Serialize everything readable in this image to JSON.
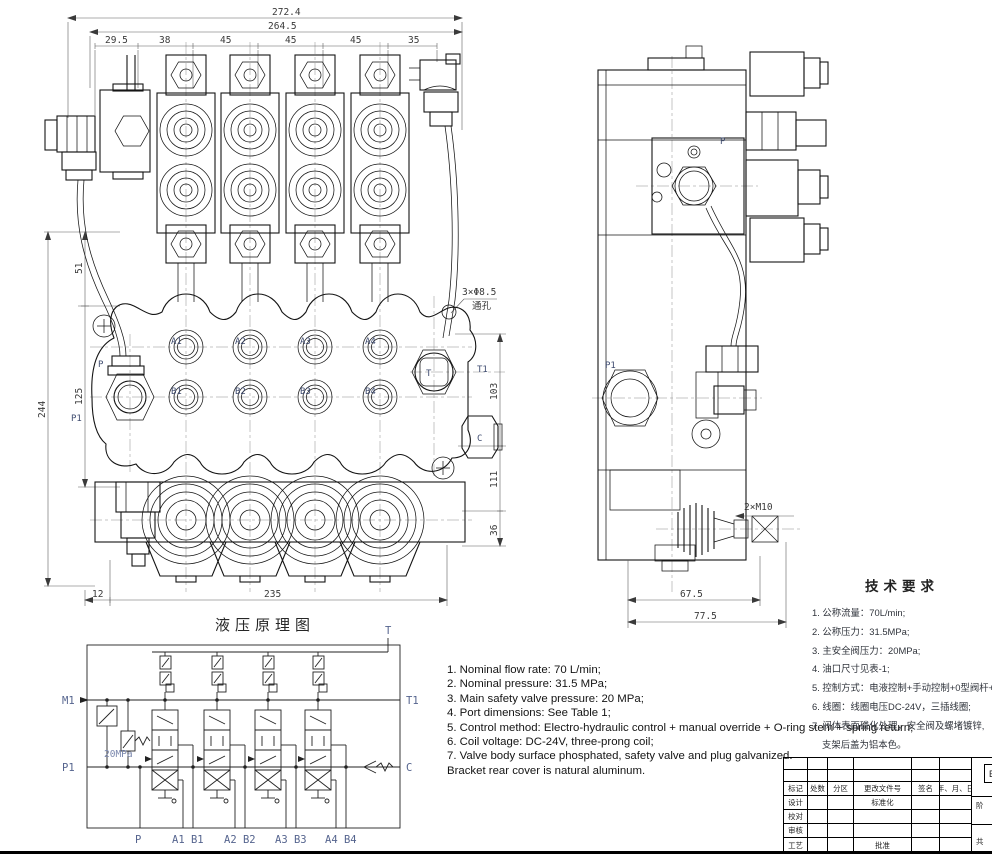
{
  "colors": {
    "line": "#141414",
    "dim_text": "#3a3a3a",
    "port_label": "#3f4c70",
    "schematic_label": "#55648e"
  },
  "drawing": {
    "front_view": {
      "dim_272": "272.4",
      "dim_264": "264.5",
      "dims_chain": [
        "29.5",
        "38",
        "45",
        "45",
        "45",
        "35"
      ],
      "dim_51": "51",
      "dim_125": "125",
      "dim_244": "244",
      "dim_12": "12",
      "dim_235": "235",
      "dim_103": "103",
      "dim_111": "111",
      "dim_36": "36",
      "hole_callout": "3×Φ8.5",
      "hole_callout_sub": "通孔",
      "ports": {
        "a": [
          "A1",
          "A2",
          "A3",
          "A4"
        ],
        "b": [
          "B1",
          "B2",
          "B3",
          "B4"
        ],
        "p": "P",
        "p1": "P1",
        "t": "T",
        "t1": "T1",
        "c": "C"
      }
    },
    "side_view": {
      "p": "P",
      "p1": "P1",
      "dim_67": "67.5",
      "dim_77": "77.5",
      "callout_m10": "2×M10"
    },
    "schematic": {
      "title": "液压原理图",
      "t": "T",
      "m1": "M1",
      "t1": "T1",
      "p1": "P1",
      "c": "C",
      "relief": "20MPa",
      "bottom": [
        "P",
        "A1 B1",
        "A2 B2",
        "A3 B3",
        "A4 B4"
      ]
    }
  },
  "notes_en": [
    "1. Nominal flow rate: 70 L/min;",
    "2. Nominal pressure: 31.5 MPa;",
    "3. Main safety valve pressure: 20 MPa;",
    "4. Port dimensions: See Table 1;",
    "5. Control method: Electro-hydraulic control + manual override + O-ring stem + spring return;",
    "6. Coil voltage: DC-24V, three-prong coil;",
    "7. Valve body surface phosphated, safety valve and plug galvanized.",
    "Bracket rear cover is natural aluminum."
  ],
  "notes_cn": {
    "title": "技术要求",
    "lines": [
      "1. 公称流量：70L/min;",
      "2. 公称压力：31.5MPa;",
      "3. 主安全阀压力：20MPa;",
      "4. 油口尺寸见表-1;",
      "5. 控制方式：电液控制+手动控制+0型阀杆+弹簧复位;",
      "6. 线圈：线圈电压DC-24V，三插线圈;",
      "7. 阀体表面磷化处理，安全阀及螺堵镀锌,",
      "支架后盖为铝本色。"
    ]
  },
  "title_block": {
    "header": [
      "标记",
      "处数",
      "分区",
      "更改文件号",
      "签名",
      "年、月、日"
    ],
    "left_col": [
      "设计",
      "校对",
      "审核",
      "工艺"
    ],
    "std_label": "标准化",
    "approve_label": "批准",
    "partial": {
      "stage": "阶",
      "total": "共",
      "mark": "E"
    }
  }
}
